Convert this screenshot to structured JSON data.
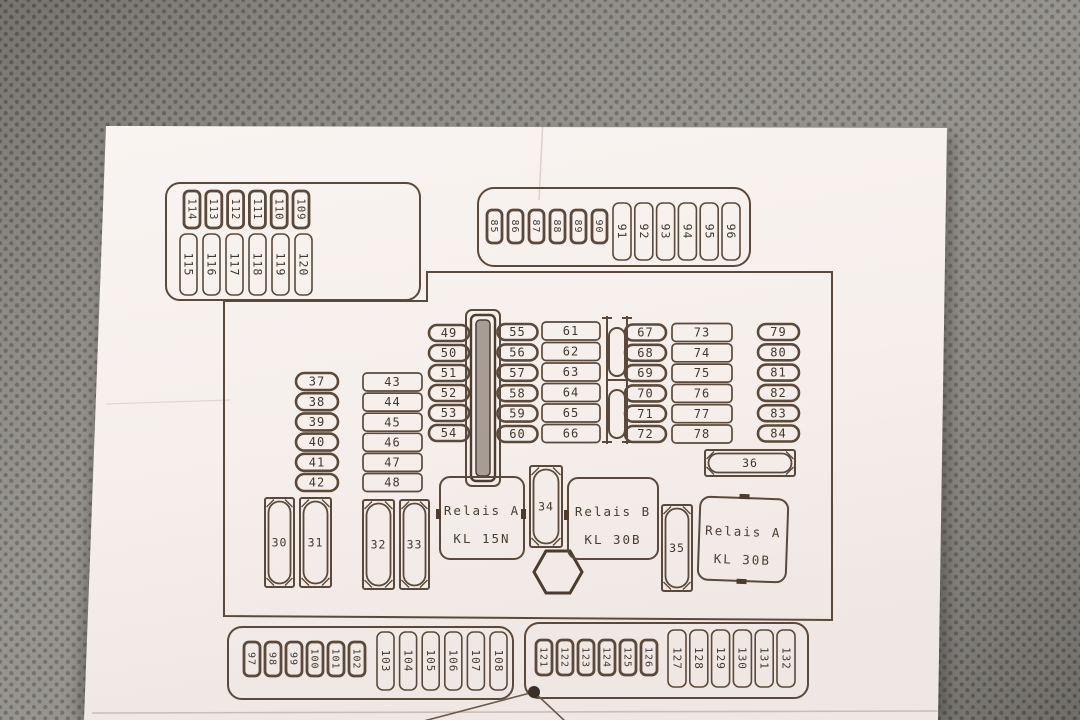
{
  "diagram": {
    "groups": {
      "top_left_small": [
        "114",
        "113",
        "112",
        "111",
        "110",
        "109"
      ],
      "top_left_tall": [
        "115",
        "116",
        "117",
        "118",
        "119",
        "120"
      ],
      "top_mid_small": [
        "85",
        "86",
        "87",
        "88",
        "89",
        "90"
      ],
      "top_mid_tall": [
        "91",
        "92",
        "93",
        "94",
        "95",
        "96"
      ],
      "col_37": [
        "37",
        "38",
        "39",
        "40",
        "41",
        "42"
      ],
      "col_43": [
        "43",
        "44",
        "45",
        "46",
        "47",
        "48"
      ],
      "col_49": [
        "49",
        "50",
        "51",
        "52",
        "53",
        "54"
      ],
      "col_55": [
        "55",
        "56",
        "57",
        "58",
        "59",
        "60"
      ],
      "col_61": [
        "61",
        "62",
        "63",
        "64",
        "65",
        "66"
      ],
      "col_67": [
        "67",
        "68",
        "69",
        "70",
        "71",
        "72"
      ],
      "col_73": [
        "73",
        "74",
        "75",
        "76",
        "77",
        "78"
      ],
      "col_79": [
        "79",
        "80",
        "81",
        "82",
        "83",
        "84"
      ],
      "bottom_left_small": [
        "97",
        "98",
        "99",
        "100",
        "101",
        "102"
      ],
      "bottom_left_tall": [
        "103",
        "104",
        "105",
        "106",
        "107",
        "108"
      ],
      "bottom_right_small": [
        "121",
        "122",
        "123",
        "124",
        "125",
        "126"
      ],
      "bottom_right_tall": [
        "127",
        "128",
        "129",
        "130",
        "131",
        "132"
      ]
    },
    "slots": {
      "fuse_30": "30",
      "fuse_31": "31",
      "fuse_32": "32",
      "fuse_33": "33",
      "fuse_34": "34",
      "fuse_35": "35",
      "fuse_36": "36"
    },
    "relays": [
      {
        "line1": "Relais A",
        "line2": "KL 15N"
      },
      {
        "line1": "Relais B",
        "line2": "KL 30B"
      },
      {
        "line1": "Relais A",
        "line2": "KL 30B"
      }
    ],
    "colors": {
      "line": "#5b4a3b",
      "text": "#44382d",
      "paper": "#f6f0ed",
      "fabric": "#8f8c87",
      "fabric_dot": "#696661"
    }
  }
}
